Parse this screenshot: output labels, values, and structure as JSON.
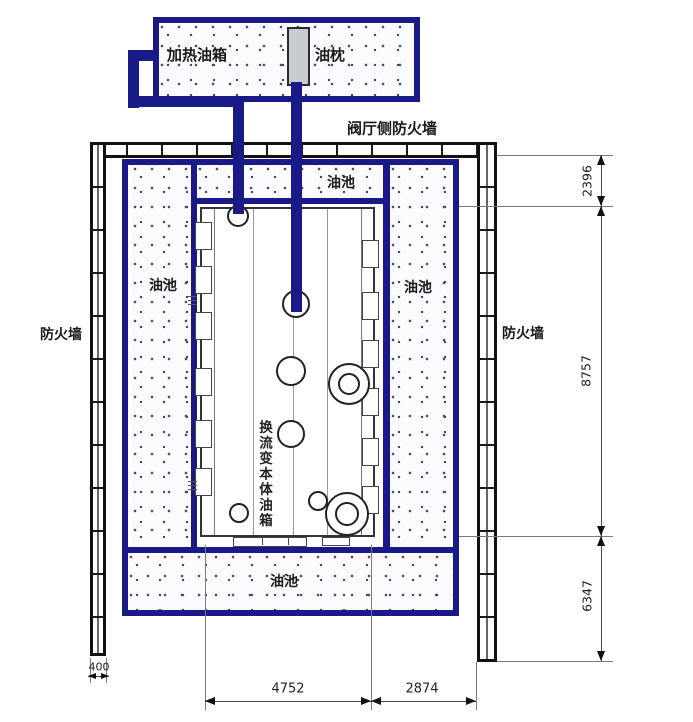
{
  "labels": {
    "heating_tank": "加热油箱",
    "oil_pillow": "油枕",
    "valve_hall_firewall": "阀厅侧防火墙",
    "firewall": "防火墙",
    "oil_pool": "油池",
    "transformer_tank": "换流变本体油箱"
  },
  "dimensions": {
    "right_top": "2396",
    "right_middle": "8757",
    "right_bottom": "6347",
    "bottom_left": "4752",
    "bottom_right": "2874",
    "wall_width": "400"
  },
  "colors": {
    "pipe_navy": "#191987",
    "wall_black": "#111111",
    "dimension_gray": "#555555",
    "stipple_dot": "#3d4e74"
  }
}
